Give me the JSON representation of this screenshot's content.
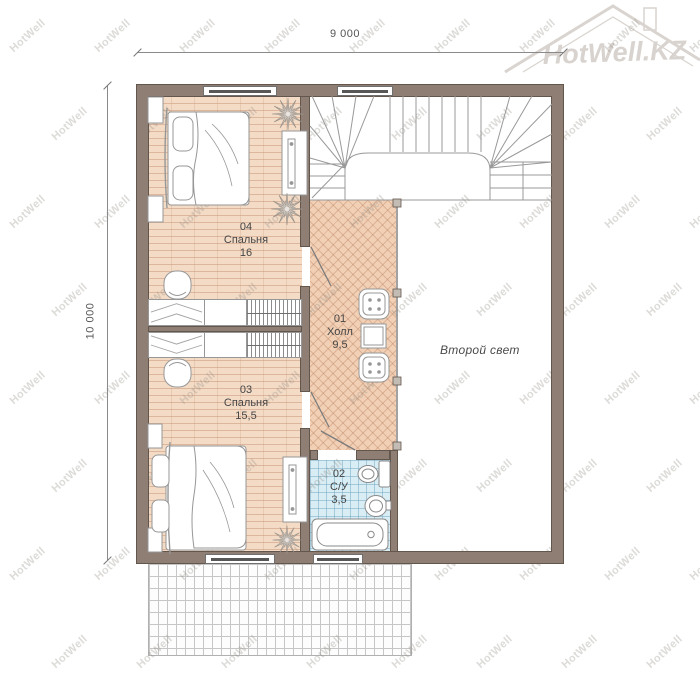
{
  "logo": {
    "text": "HotWell.KZ"
  },
  "watermark": {
    "text": "HotWell"
  },
  "dimensions": {
    "width_top": "9 000",
    "height_left": "10 000"
  },
  "rooms": [
    {
      "number": "04",
      "name": "Спальня",
      "area": "16"
    },
    {
      "number": "03",
      "name": "Спальня",
      "area": "15,5"
    },
    {
      "number": "01",
      "name": "Холл",
      "area": "9,5"
    },
    {
      "number": "02",
      "name": "С/У",
      "area": "3,5"
    }
  ],
  "annotations": {
    "second_light": "Второй свет"
  },
  "colors": {
    "wall": "#8e7e74",
    "wall_outline": "#63564d",
    "bedroom_floor": "#f3dbc6",
    "hall_floor": "#f1d0b6",
    "bathroom_tile": "#d9edf5",
    "line_gray": "#999999",
    "label_text": "#454545"
  }
}
